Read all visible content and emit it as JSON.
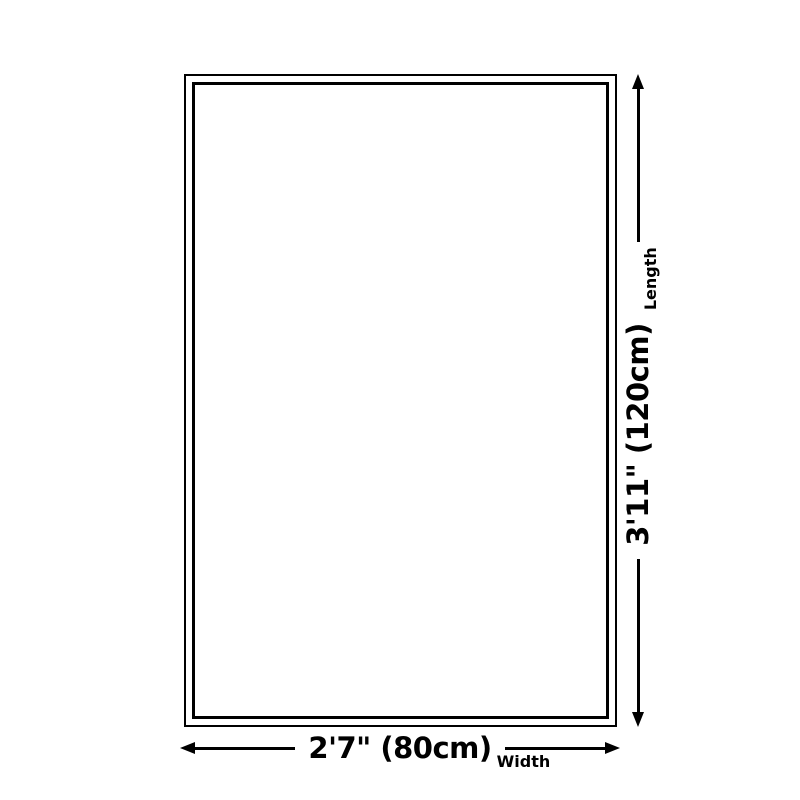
{
  "diagram": {
    "background_color": "#ffffff",
    "line_color": "#000000",
    "width": {
      "value": "2'7\" (80cm)",
      "label": "Width"
    },
    "length": {
      "value": "3'11\" (120cm)",
      "label": "Length"
    }
  }
}
